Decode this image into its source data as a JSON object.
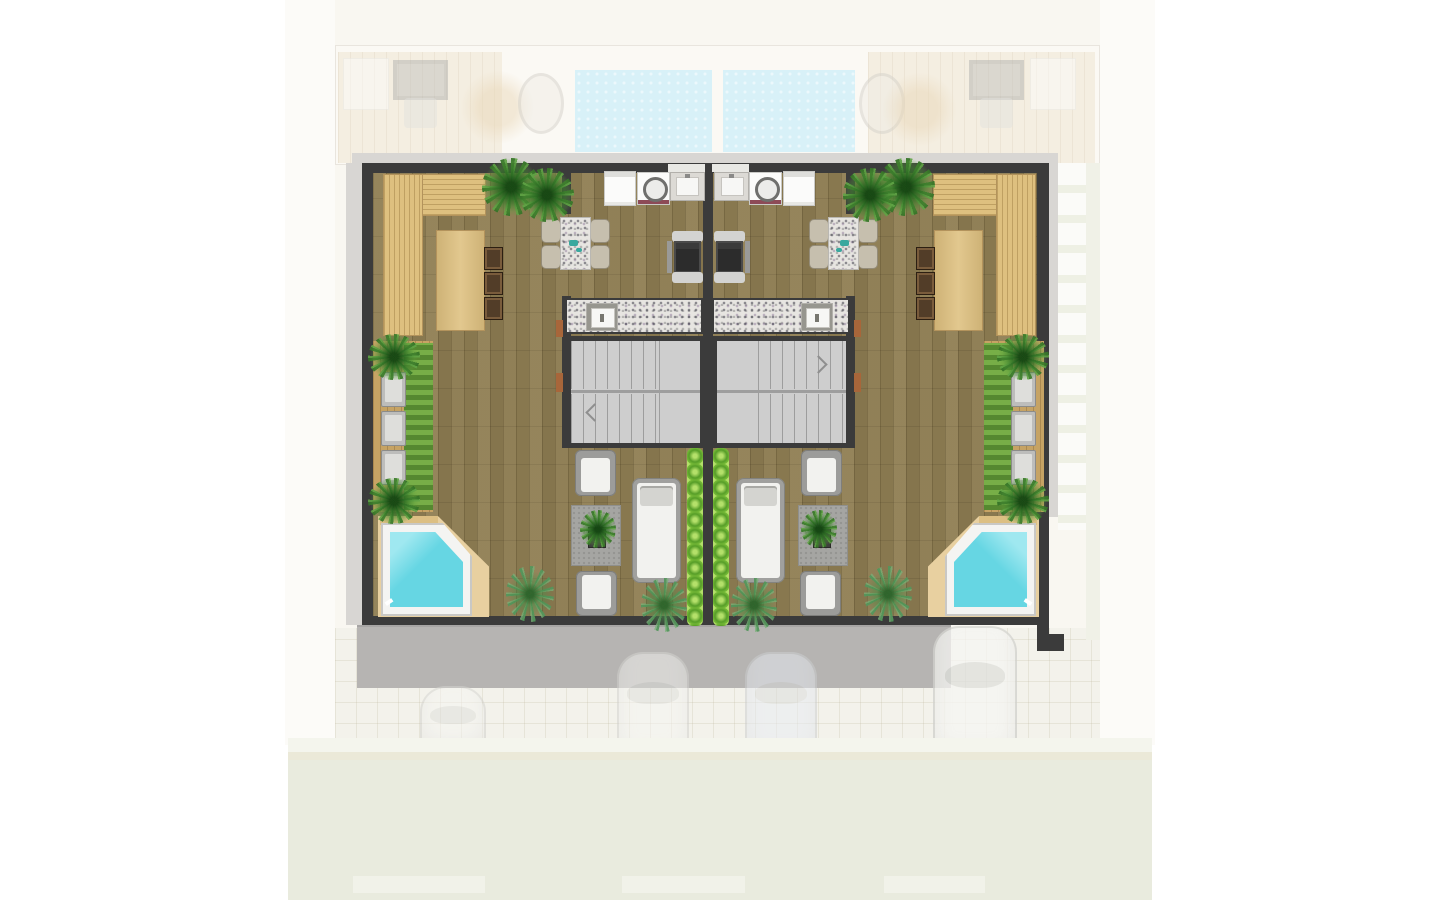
{
  "scene": {
    "kind": "architectural floor plan, top-down rendered",
    "subject": "rooftop terrace level of two mirrored attached villas",
    "visible_text": "none"
  },
  "palette": {
    "wall": "#3b3b3b",
    "trim": "#d8d6d3",
    "wood_deck": "#8d7c52",
    "light_wood": "#dec07f",
    "granite": "#e7e5e1",
    "chair_tan": "#c6bfae",
    "pool_water": "#66d6e3",
    "pool_shallow": "#9fe8f0",
    "pool_rim": "#f4f4f2",
    "tan_deck": "#e8d0a0",
    "ghost_pool": "#d8f1f8",
    "hedge": "#7dc03b",
    "plant_green": "#4e8a34",
    "slab_gray": "#b6b4b2",
    "street_band": "#e9ebde",
    "door_wood": "#a8663a",
    "teal": "#3aa89e"
  },
  "plan": {
    "units": [
      {
        "id": "left-unit",
        "features": [
          "l-shaped-corner-bench",
          "bar-table-with-3-stools",
          "dining-table-with-4-chairs",
          "dishwasher",
          "washing-machine",
          "laundry-sink",
          "grill-station",
          "outdoor-counter-with-sink",
          "switchback-staircase",
          "side-planter-with-3-loungers",
          "2-lounge-armchairs",
          "chaise-lounge",
          "rug-with-potted-plant",
          "plunge-pool-with-tan-deck",
          "privacy-hedge",
          "ornamental-plants"
        ]
      },
      {
        "id": "right-unit",
        "mirrored": true,
        "features": [
          "l-shaped-corner-bench",
          "bar-table-with-3-stools",
          "dining-table-with-4-chairs",
          "dishwasher",
          "washing-machine",
          "laundry-sink",
          "grill-station",
          "outdoor-counter-with-sink",
          "switchback-staircase",
          "side-planter-with-3-loungers",
          "2-lounge-armchairs",
          "chaise-lounge",
          "rug-with-potted-plant",
          "plunge-pool-with-tan-deck",
          "privacy-hedge",
          "ornamental-plants"
        ]
      }
    ],
    "surroundings": [
      "faded-lower-floor-strip-with-two-pools-and-patio-furniture",
      "gray-driveway-slab",
      "four-faded-parked-cars-on-pavers",
      "white-paver-path-right-side",
      "light-street-band-bottom"
    ]
  }
}
